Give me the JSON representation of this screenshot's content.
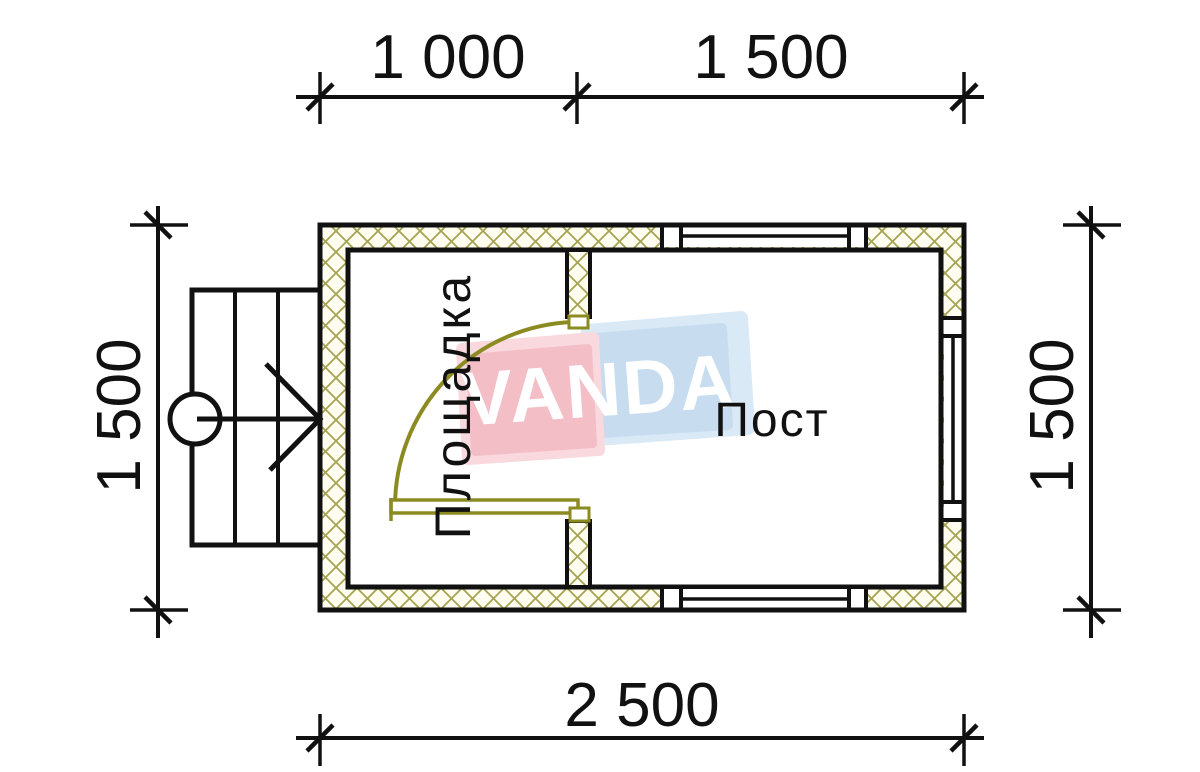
{
  "drawing_type": "floor-plan",
  "watermark": {
    "text": "VANDA"
  },
  "rooms": {
    "left": "Площадка",
    "right": "Пост"
  },
  "dimensions": {
    "top_left": "1 000",
    "top_right": "1 500",
    "bottom": "2 500",
    "left": "1 500",
    "right": "1 500"
  },
  "colors": {
    "hatch_olive": "#a6a452",
    "door_olive": "#8b8b22",
    "line_black": "#111111",
    "wall_fill": "#fffdf0",
    "watermark_pink": "#f4bec7",
    "watermark_pink_light": "#f9d9dd",
    "watermark_blue": "#c7ddef",
    "watermark_blue_light": "#d9e9f6"
  }
}
